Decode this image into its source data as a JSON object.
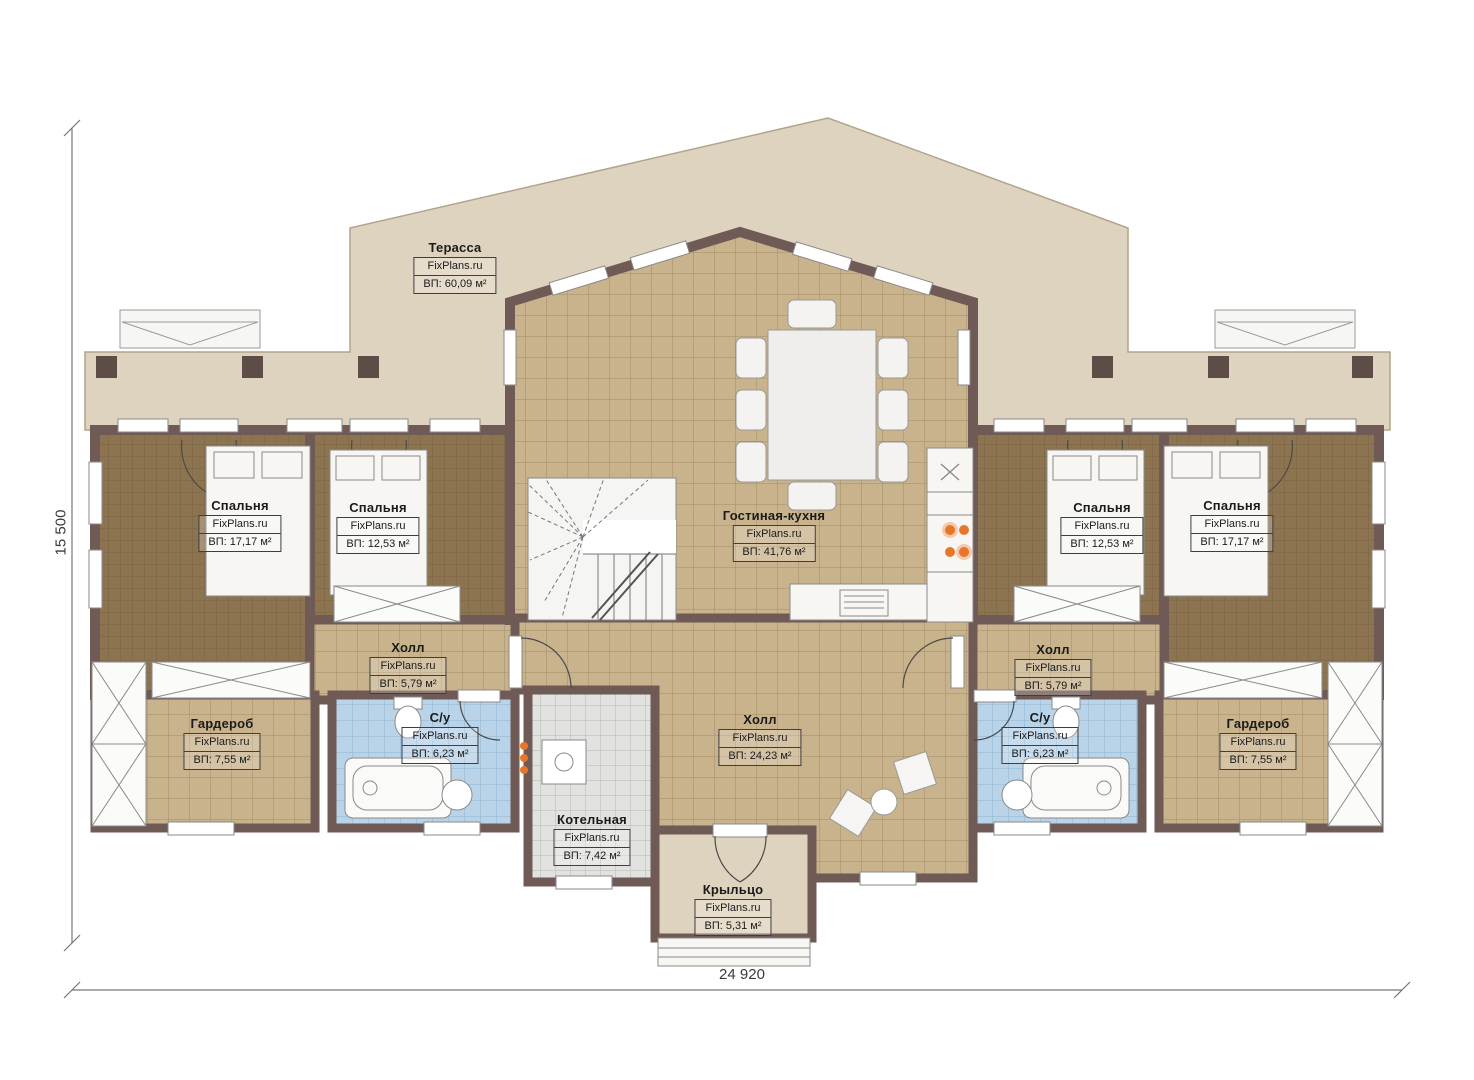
{
  "brand": "FixPlans.ru",
  "dimensions": {
    "left_vertical": "15 500",
    "bottom_horizontal": "24 920"
  },
  "rooms": [
    {
      "name": "Терасса",
      "brand": "FixPlans.ru",
      "area": "ВП: 60,09 м²"
    },
    {
      "name": "Спальня",
      "brand": "FixPlans.ru",
      "area": "ВП: 17,17 м²"
    },
    {
      "name": "Спальня",
      "brand": "FixPlans.ru",
      "area": "ВП: 12,53 м²"
    },
    {
      "name": "Гостиная-кухня",
      "brand": "FixPlans.ru",
      "area": "ВП: 41,76 м²"
    },
    {
      "name": "Спальня",
      "brand": "FixPlans.ru",
      "area": "ВП: 12,53 м²"
    },
    {
      "name": "Спальня",
      "brand": "FixPlans.ru",
      "area": "ВП: 17,17 м²"
    },
    {
      "name": "Холл",
      "brand": "FixPlans.ru",
      "area": "ВП: 5,79 м²"
    },
    {
      "name": "Холл",
      "brand": "FixPlans.ru",
      "area": "ВП: 5,79 м²"
    },
    {
      "name": "Гардероб",
      "brand": "FixPlans.ru",
      "area": "ВП: 7,55 м²"
    },
    {
      "name": "С/у",
      "brand": "FixPlans.ru",
      "area": "ВП: 6,23 м²"
    },
    {
      "name": "Холл",
      "brand": "FixPlans.ru",
      "area": "ВП: 24,23 м²"
    },
    {
      "name": "С/у",
      "brand": "FixPlans.ru",
      "area": "ВП: 6,23 м²"
    },
    {
      "name": "Гардероб",
      "brand": "FixPlans.ru",
      "area": "ВП: 7,55 м²"
    },
    {
      "name": "Котельная",
      "brand": "FixPlans.ru",
      "area": "ВП: 7,42 м²"
    },
    {
      "name": "Крыльцо",
      "brand": "FixPlans.ru",
      "area": "ВП: 5,31 м²"
    }
  ],
  "colors": {
    "wall": "#6f5a56",
    "terrace": "#ded3be",
    "floor_tan": "#c9b38c",
    "carpet_brown": "#8d7450",
    "bathroom_blue": "#b9d3e8",
    "boiler_gray": "#e2e2e0",
    "burner_orange": "#e8762a",
    "background": "#ffffff"
  }
}
